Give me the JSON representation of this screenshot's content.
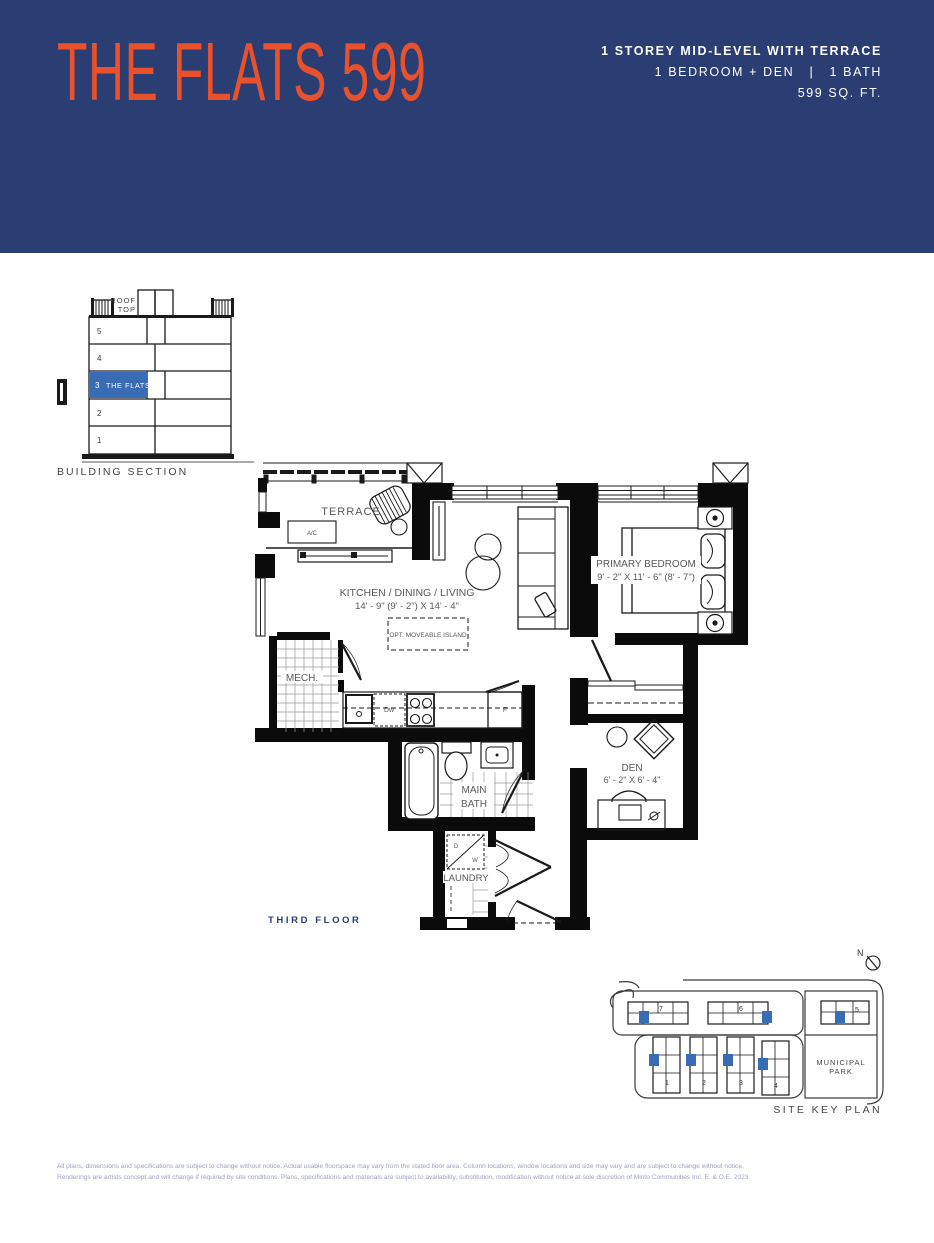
{
  "header": {
    "title": "THE FLATS 599",
    "line1": "1 STOREY MID-LEVEL WITH TERRACE",
    "line2": "1 BEDROOM + DEN   |   1 BATH",
    "line3": "599 SQ. FT.",
    "accent_color": "#E8512B",
    "navy_color": "#2B3E73"
  },
  "building_section": {
    "label": "BUILDING SECTION",
    "roof1": "ROOF",
    "roof2": "TOP",
    "floors": [
      "5",
      "4",
      "3",
      "2",
      "1"
    ],
    "flats_label": "THE FLATS",
    "highlight_color": "#3A6BB5"
  },
  "floor_plan": {
    "floor_label": "THIRD FLOOR",
    "terrace": "TERRACE",
    "ac": "A/C",
    "kitchen_name": "KITCHEN / DINING / LIVING",
    "kitchen_dims": "14' - 9\" (9' - 2\") X 14' - 4\"",
    "island": "OPT. MOVEABLE ISLAND",
    "mech": "MECH.",
    "bedroom_name": "PRIMARY BEDROOM",
    "bedroom_dims": "9' - 2\" X 11' - 6\" (8' - 7\")",
    "bath1": "MAIN",
    "bath2": "BATH",
    "den_name": "DEN",
    "den_dims": "6' - 2\" X 6' - 4\"",
    "laundry": "LAUNDRY",
    "dishwasher": "Dw",
    "fridge": "F",
    "dryer": "D",
    "washer": "W"
  },
  "site_plan": {
    "label": "SITE KEY PLAN",
    "north": "N",
    "park1": "MUNICIPAL",
    "park2": "PARK",
    "buildings": [
      "7",
      "6",
      "5",
      "1",
      "2",
      "3",
      "4"
    ],
    "unit_color": "#3A6BB5"
  },
  "disclaimer": {
    "line1": "All plans, dimensions and specifications are subject to change without notice. Actual usable floorspace may vary from the stated floor area. Column locations, window locations and size may vary and are subject to change without notice.",
    "line2": "Renderings are artists concept and will change if required by site conditions. Plans, specifications and materials are subject to availability, substitution, modification without notice at sole discretion of Minto Communities Inc. E. & O.E. 2023"
  }
}
